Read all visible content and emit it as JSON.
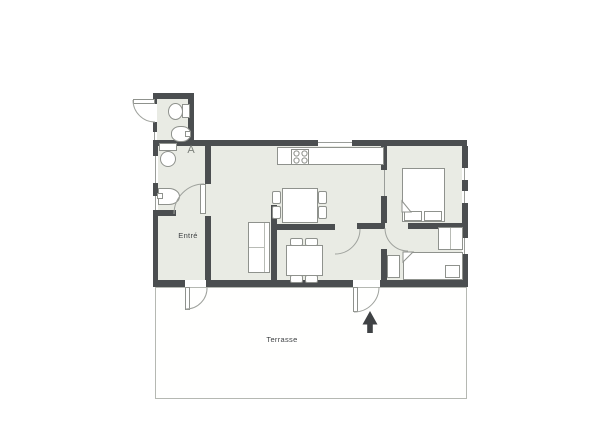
{
  "plan": {
    "labels": {
      "entrance": "Entré",
      "terrace": "Terrasse",
      "bath_symbol": "A"
    },
    "colors": {
      "wall": "#4b4e50",
      "floor": "#e9ebe4",
      "furniture_outline": "#8f928d",
      "door_arc": "#9fa29d",
      "terrace_border": "#b5b8b2",
      "text": "#3f4244",
      "north_arrow": "#3f4244"
    }
  }
}
